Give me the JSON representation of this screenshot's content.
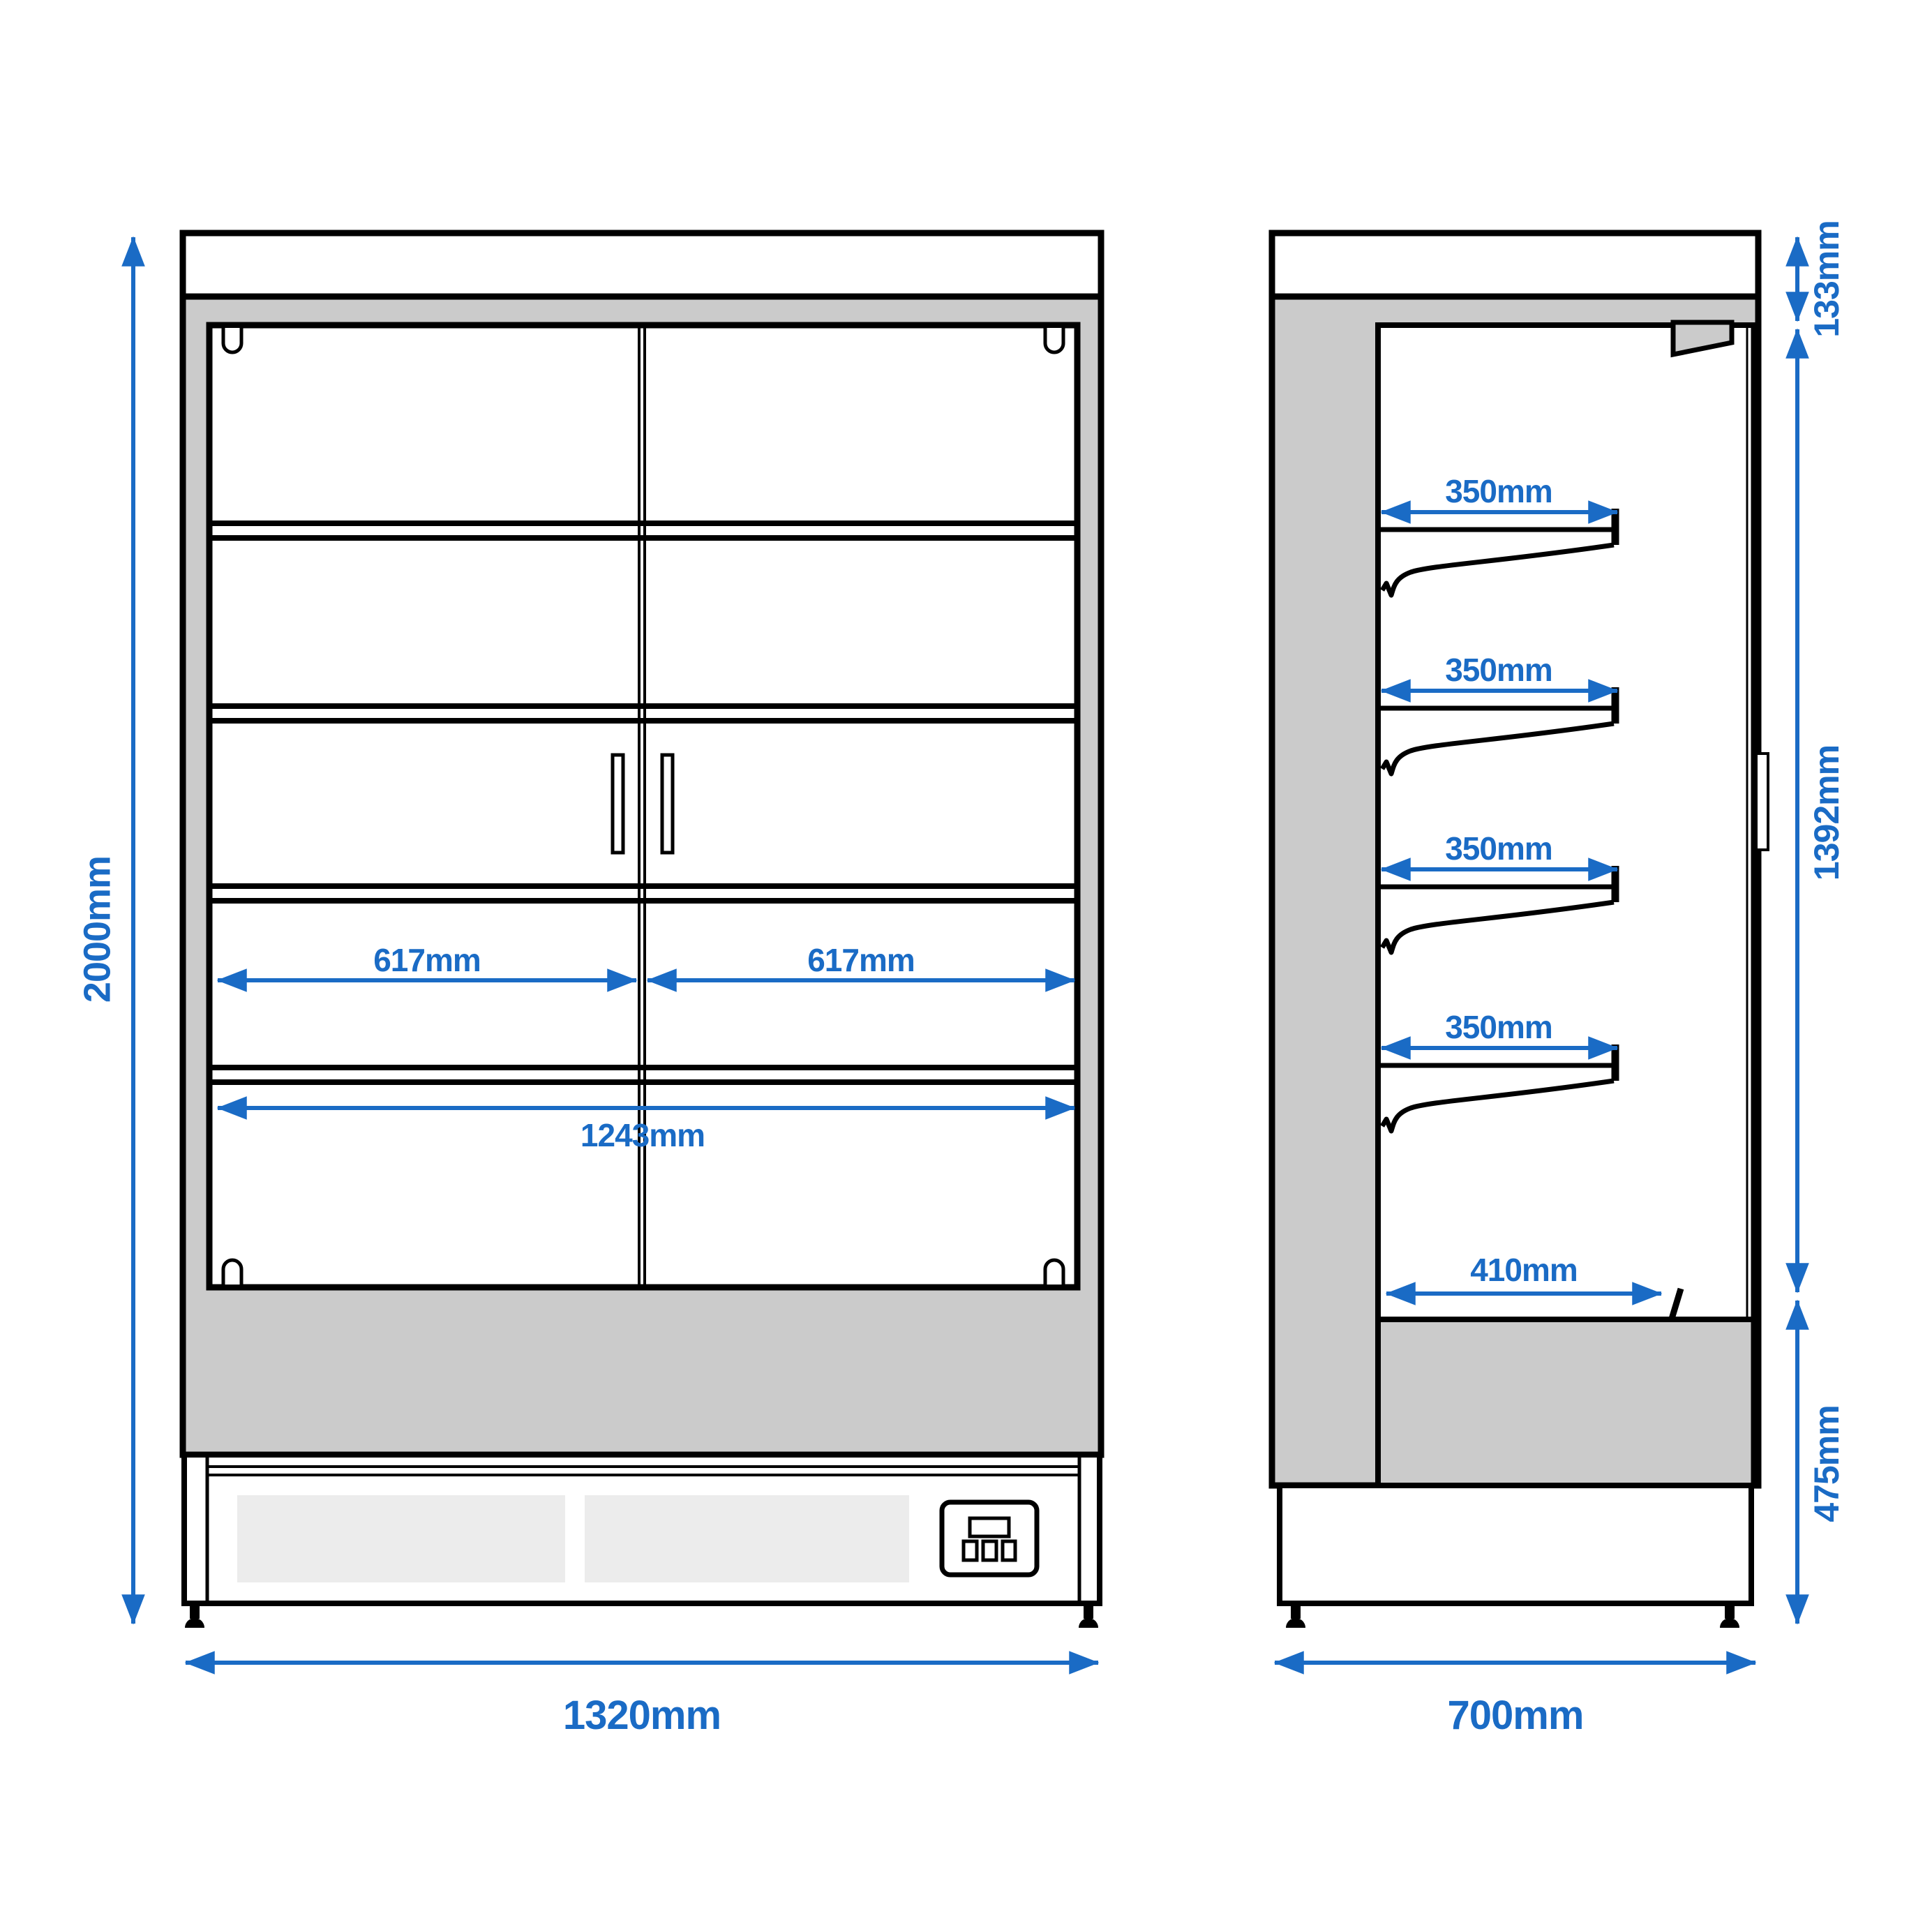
{
  "colors": {
    "accent_blue": "#1a6bc5",
    "cabinet_grey": "#cbcbcb",
    "vent_grey": "#ececec",
    "outline_black": "#000000"
  },
  "front_view": {
    "dimensions": {
      "overall_height": "2000mm",
      "overall_width": "1320mm",
      "left_door_width": "617mm",
      "right_door_width": "617mm",
      "inner_width": "1243mm"
    }
  },
  "side_view": {
    "dimensions": {
      "canopy_height": "133mm",
      "display_opening_height": "1392mm",
      "base_height": "475mm",
      "overall_depth": "700mm",
      "shelf_depths": [
        "350mm",
        "350mm",
        "350mm",
        "350mm"
      ],
      "bottom_shelf_depth": "410mm"
    }
  }
}
